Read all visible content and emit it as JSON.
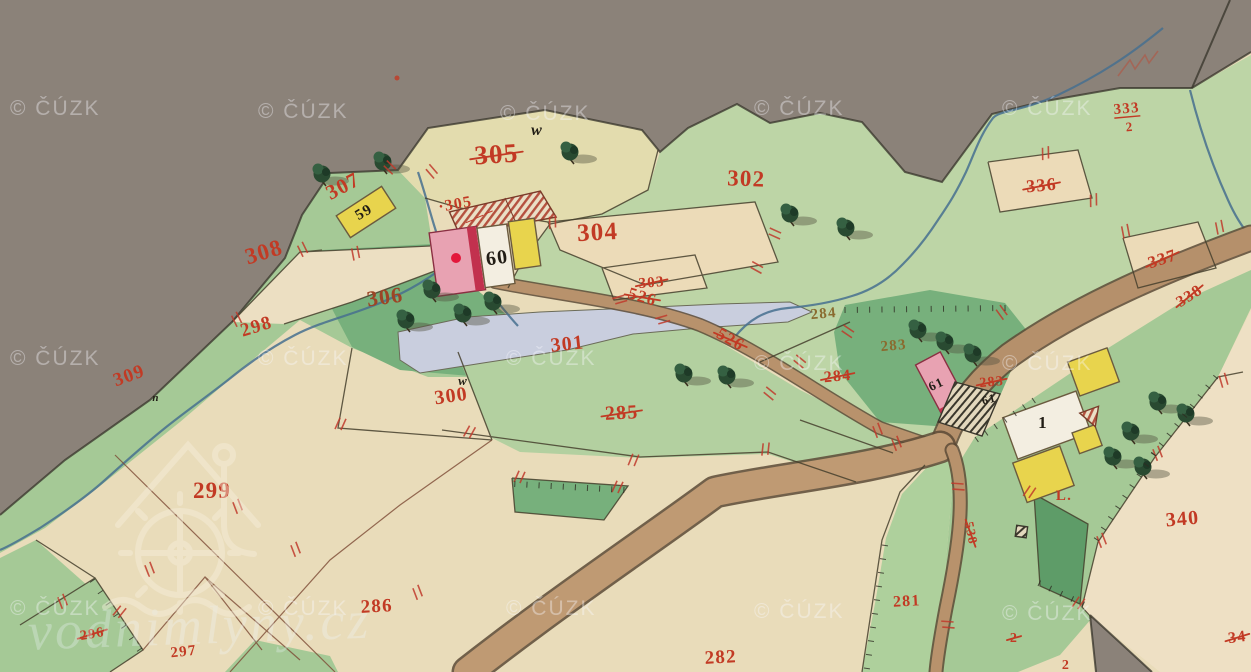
{
  "map": {
    "title": "historical cadastral map sheet",
    "labels": [
      {
        "t": "305",
        "x": 497,
        "y": 163,
        "r": -4,
        "c": "red",
        "s": 27,
        "x2": true
      },
      {
        "t": "·305",
        "x": 456,
        "y": 209,
        "r": -10,
        "c": "red",
        "s": 16
      },
      {
        "t": "307",
        "x": 346,
        "y": 192,
        "r": -28,
        "c": "red",
        "s": 21
      },
      {
        "t": "59",
        "x": 366,
        "y": 216,
        "r": -30,
        "c": "black",
        "s": 15
      },
      {
        "t": "w",
        "x": 537,
        "y": 135,
        "r": 0,
        "c": "black",
        "s": 16,
        "i": true
      },
      {
        "t": "304",
        "x": 598,
        "y": 240,
        "r": -3,
        "c": "red",
        "s": 25
      },
      {
        "t": "302",
        "x": 746,
        "y": 186,
        "r": 2,
        "c": "red",
        "s": 23
      },
      {
        "t": "303",
        "x": 652,
        "y": 287,
        "r": -5,
        "c": "red",
        "s": 15,
        "x2": true
      },
      {
        "t": "526",
        "x": 641,
        "y": 302,
        "r": 16,
        "c": "red",
        "s": 17,
        "x2": true
      },
      {
        "t": "526",
        "x": 728,
        "y": 344,
        "r": 30,
        "c": "red",
        "s": 17,
        "x2": true
      },
      {
        "t": "308",
        "x": 266,
        "y": 259,
        "r": -17,
        "c": "red",
        "s": 23
      },
      {
        "t": "306",
        "x": 386,
        "y": 304,
        "r": -8,
        "c": "dred",
        "s": 22
      },
      {
        "t": "298",
        "x": 258,
        "y": 332,
        "r": -17,
        "c": "red",
        "s": 19
      },
      {
        "t": "309",
        "x": 131,
        "y": 381,
        "r": -20,
        "c": "red",
        "s": 19
      },
      {
        "t": "n",
        "x": 156,
        "y": 401,
        "r": 0,
        "c": "black",
        "s": 11,
        "i": true
      },
      {
        "t": "w",
        "x": 463,
        "y": 385,
        "r": 0,
        "c": "black",
        "s": 13,
        "i": true
      },
      {
        "t": "300",
        "x": 452,
        "y": 402,
        "r": -8,
        "c": "red",
        "s": 20
      },
      {
        "t": "301",
        "x": 568,
        "y": 350,
        "r": -6,
        "c": "red",
        "s": 20
      },
      {
        "t": "285",
        "x": 622,
        "y": 419,
        "r": -3,
        "c": "red",
        "s": 20,
        "x2": true
      },
      {
        "t": "284",
        "x": 824,
        "y": 318,
        "r": -5,
        "c": "olive",
        "s": 15
      },
      {
        "t": "284",
        "x": 838,
        "y": 381,
        "r": -5,
        "c": "red",
        "s": 16,
        "x2": true
      },
      {
        "t": "283",
        "x": 894,
        "y": 350,
        "r": -5,
        "c": "olive",
        "s": 15
      },
      {
        "t": "283",
        "x": 992,
        "y": 386,
        "r": -5,
        "c": "red",
        "s": 14,
        "x2": true
      },
      {
        "t": "60",
        "x": 498,
        "y": 264,
        "r": -8,
        "c": "black",
        "s": 20
      },
      {
        "t": "61",
        "x": 938,
        "y": 388,
        "r": -25,
        "c": "black",
        "s": 13
      },
      {
        "t": "61",
        "x": 990,
        "y": 403,
        "r": -15,
        "c": "black",
        "s": 12
      },
      {
        "t": "1",
        "x": 1043,
        "y": 428,
        "r": 0,
        "c": "black",
        "s": 17
      },
      {
        "t": "L.",
        "x": 1064,
        "y": 500,
        "r": 0,
        "c": "red",
        "s": 15
      },
      {
        "t": "333",
        "x": 1127,
        "y": 113,
        "r": -5,
        "c": "red",
        "s": 15,
        "ul": true
      },
      {
        "t": "2",
        "x": 1130,
        "y": 131,
        "r": -5,
        "c": "red",
        "s": 13
      },
      {
        "t": "336",
        "x": 1042,
        "y": 191,
        "r": -5,
        "c": "red",
        "s": 18,
        "x2": true
      },
      {
        "t": "337",
        "x": 1164,
        "y": 264,
        "r": -18,
        "c": "red",
        "s": 17,
        "x2": true
      },
      {
        "t": "338",
        "x": 1192,
        "y": 300,
        "r": -33,
        "c": "red",
        "s": 16,
        "x2": true
      },
      {
        "t": "340",
        "x": 1183,
        "y": 525,
        "r": -5,
        "c": "red",
        "s": 20
      },
      {
        "t": "34",
        "x": 1238,
        "y": 642,
        "r": -8,
        "c": "red",
        "s": 16,
        "x2": true
      },
      {
        "t": "281",
        "x": 907,
        "y": 606,
        "r": -3,
        "c": "red",
        "s": 16
      },
      {
        "t": "2",
        "x": 1014,
        "y": 642,
        "r": 0,
        "c": "red",
        "s": 14,
        "x2": true
      },
      {
        "t": "2",
        "x": 1066,
        "y": 669,
        "r": 0,
        "c": "red",
        "s": 14
      },
      {
        "t": "538",
        "x": 967,
        "y": 534,
        "r": 78,
        "c": "red",
        "s": 13,
        "x2": true
      },
      {
        "t": "282",
        "x": 721,
        "y": 663,
        "r": -3,
        "c": "red",
        "s": 19
      },
      {
        "t": "286",
        "x": 377,
        "y": 612,
        "r": -3,
        "c": "red",
        "s": 19
      },
      {
        "t": "299",
        "x": 212,
        "y": 498,
        "r": 0,
        "c": "red",
        "s": 23
      },
      {
        "t": "296",
        "x": 93,
        "y": 638,
        "r": -10,
        "c": "red",
        "s": 14,
        "x2": true
      },
      {
        "t": "297",
        "x": 184,
        "y": 656,
        "r": -6,
        "c": "red",
        "s": 15
      }
    ]
  },
  "watermark": {
    "text": "© ČÚZK",
    "positions": [
      [
        10,
        115
      ],
      [
        258,
        118
      ],
      [
        500,
        120
      ],
      [
        754,
        115
      ],
      [
        1002,
        115
      ],
      [
        10,
        365
      ],
      [
        258,
        365
      ],
      [
        506,
        365
      ],
      [
        754,
        370
      ],
      [
        1002,
        370
      ],
      [
        10,
        615
      ],
      [
        258,
        615
      ],
      [
        506,
        615
      ],
      [
        754,
        618
      ],
      [
        1002,
        620
      ]
    ]
  },
  "brand": {
    "text": "vodnimlyny.cz"
  },
  "palette": {
    "paper": "#e9dcba",
    "paper_light": "#eee0c4",
    "outside_gray": "#8b8279",
    "green_light": "#bdd5a6",
    "green_mid": "#a5c996",
    "green_dark": "#77b07c",
    "green_deep": "#5e9c68",
    "road": "#b5906b",
    "stream": "#47708f",
    "pond": "#c9cede",
    "building_pink": "#e8a2b2",
    "building_red": "#c2314e",
    "building_yellow": "#e8d44d",
    "building_white": "#f3eee1",
    "label_red": "#c23a24",
    "label_olive": "#8a6b2f",
    "label_black": "#211d15"
  }
}
